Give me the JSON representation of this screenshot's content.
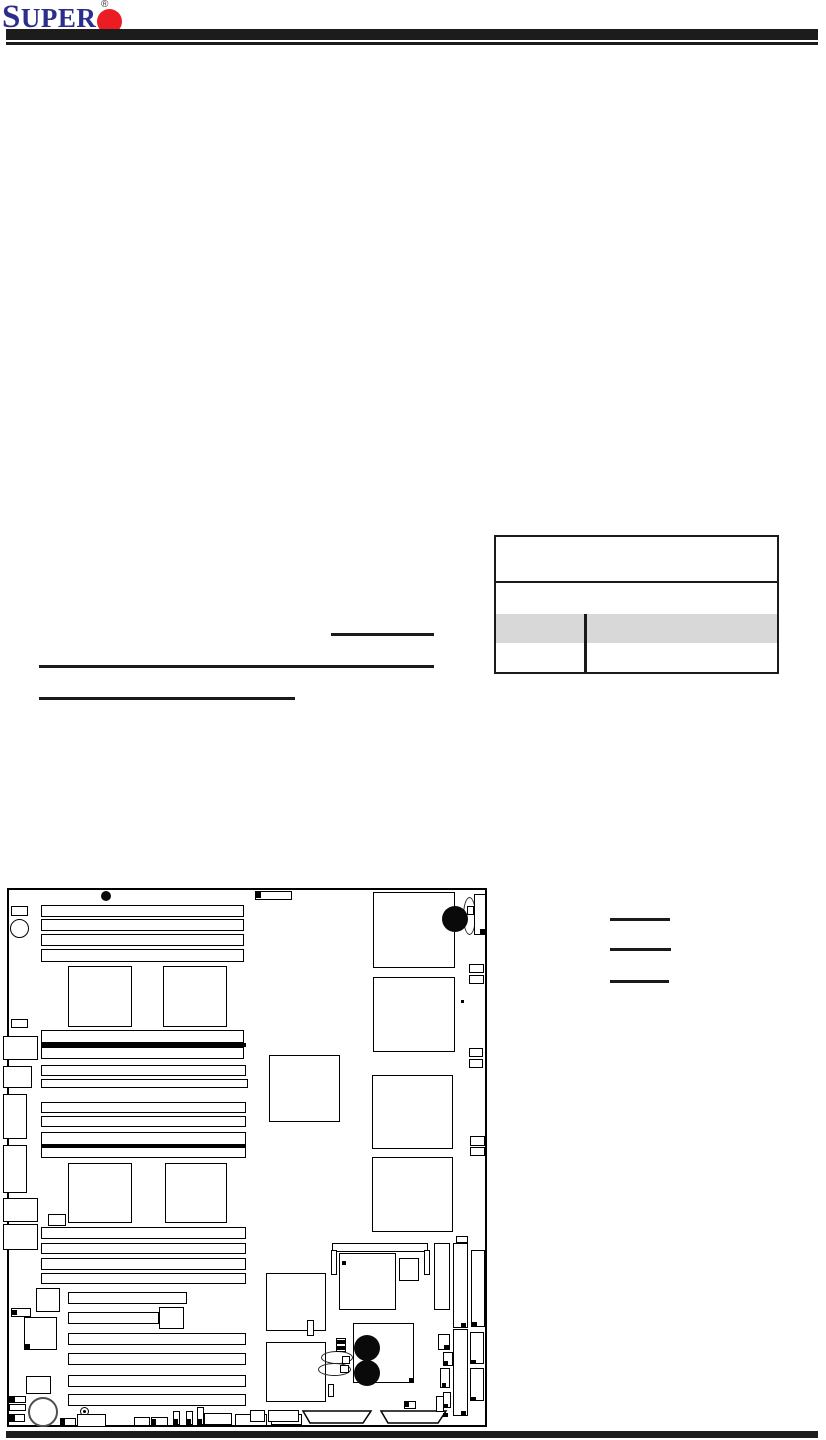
{
  "header": {
    "logo_text": "SUPER",
    "registered_mark": "®"
  },
  "colors": {
    "logo_blue": "#2b2e8c",
    "logo_red": "#ec1c24",
    "rule_black": "#1c1c1c",
    "table_shaded_row": "#d8d8d8"
  },
  "table": {
    "note": "empty specification table with header row, one plain row, one shaded row and one bottom row, split by a vertical divider"
  },
  "annotations": {
    "lines": [
      {
        "n": "text-underline-1",
        "x": 331,
        "y": 633,
        "w": 103,
        "h": 3
      },
      {
        "n": "text-underline-2",
        "x": 39,
        "y": 665,
        "w": 395,
        "h": 3
      },
      {
        "n": "text-underline-3",
        "x": 39,
        "y": 697,
        "w": 256,
        "h": 3
      },
      {
        "n": "legend-line-1",
        "x": 610,
        "y": 918,
        "w": 60,
        "h": 3
      },
      {
        "n": "legend-line-2",
        "x": 610,
        "y": 948,
        "w": 61,
        "h": 3
      },
      {
        "n": "legend-line-3",
        "x": 610,
        "y": 980,
        "w": 59,
        "h": 3
      }
    ]
  },
  "diagram": {
    "description": "motherboard layout drawing",
    "shapes": [
      {
        "t": "box",
        "x": 7,
        "y": 888,
        "w": 480,
        "h": 539,
        "bw": 2,
        "n": "board-outline"
      },
      {
        "t": "fillcircle",
        "x": 101,
        "y": 891,
        "w": 10,
        "h": 10,
        "n": "mounting-hole"
      },
      {
        "t": "box",
        "x": 11,
        "y": 906,
        "w": 17,
        "h": 10,
        "n": "connector"
      },
      {
        "t": "circle",
        "x": 10,
        "y": 919,
        "w": 19,
        "h": 19,
        "n": "mounting-hole"
      },
      {
        "t": "box",
        "x": 255,
        "y": 891,
        "w": 37,
        "h": 9,
        "n": "connector"
      },
      {
        "t": "fill",
        "x": 256,
        "y": 892,
        "w": 5,
        "h": 6,
        "n": "pin1-mark"
      },
      {
        "t": "box",
        "x": 41,
        "y": 905,
        "w": 203,
        "h": 12,
        "n": "dimm-slot"
      },
      {
        "t": "box",
        "x": 41,
        "y": 919,
        "w": 203,
        "h": 12,
        "n": "dimm-slot"
      },
      {
        "t": "box",
        "x": 41,
        "y": 934,
        "w": 203,
        "h": 12,
        "n": "dimm-slot"
      },
      {
        "t": "box",
        "x": 41,
        "y": 949,
        "w": 203,
        "h": 13,
        "n": "dimm-slot"
      },
      {
        "t": "box",
        "x": 68,
        "y": 966,
        "w": 64,
        "h": 61,
        "n": "cpu-socket"
      },
      {
        "t": "box",
        "x": 163,
        "y": 966,
        "w": 64,
        "h": 61,
        "n": "cpu-socket"
      },
      {
        "t": "box",
        "x": 373,
        "y": 892,
        "w": 82,
        "h": 76,
        "n": "chip"
      },
      {
        "t": "ellipse",
        "x": 463,
        "y": 897,
        "w": 13,
        "h": 38,
        "n": "battery"
      },
      {
        "t": "box",
        "x": 474,
        "y": 894,
        "w": 12,
        "h": 41,
        "n": "connector"
      },
      {
        "t": "fillcircle",
        "x": 442,
        "y": 906,
        "w": 26,
        "h": 26,
        "n": "capacitor"
      },
      {
        "t": "box",
        "x": 467,
        "y": 906,
        "w": 7,
        "h": 9,
        "n": "connector"
      },
      {
        "t": "fill",
        "x": 480,
        "y": 929,
        "w": 5,
        "h": 5,
        "n": "pin1-mark"
      },
      {
        "t": "box",
        "x": 469,
        "y": 964,
        "w": 15,
        "h": 9,
        "n": "connector"
      },
      {
        "t": "box",
        "x": 469,
        "y": 975,
        "w": 15,
        "h": 9,
        "n": "connector"
      },
      {
        "t": "box",
        "x": 373,
        "y": 977,
        "w": 82,
        "h": 75,
        "n": "chip"
      },
      {
        "t": "fill",
        "x": 461,
        "y": 1000,
        "w": 3,
        "h": 3,
        "n": "dot"
      },
      {
        "t": "box",
        "x": 11,
        "y": 1019,
        "w": 17,
        "h": 9,
        "n": "connector"
      },
      {
        "t": "box",
        "x": 41,
        "y": 1030,
        "w": 203,
        "h": 13,
        "n": "dimm-slot"
      },
      {
        "t": "fill",
        "x": 41,
        "y": 1043,
        "w": 205,
        "h": 4,
        "n": "slot-divider"
      },
      {
        "t": "box",
        "x": 41,
        "y": 1047,
        "w": 203,
        "h": 12,
        "n": "dimm-slot"
      },
      {
        "t": "box",
        "x": 41,
        "y": 1065,
        "w": 205,
        "h": 11,
        "n": "dimm-slot"
      },
      {
        "t": "box",
        "x": 41,
        "y": 1079,
        "w": 207,
        "h": 9,
        "n": "dimm-slot"
      },
      {
        "t": "box",
        "x": 3,
        "y": 1036,
        "w": 35,
        "h": 24,
        "n": "io-port"
      },
      {
        "t": "box",
        "x": 3,
        "y": 1066,
        "w": 29,
        "h": 22,
        "n": "io-port"
      },
      {
        "t": "box",
        "x": 3,
        "y": 1094,
        "w": 24,
        "h": 45,
        "n": "io-port"
      },
      {
        "t": "box",
        "x": 3,
        "y": 1145,
        "w": 24,
        "h": 48,
        "n": "io-port"
      },
      {
        "t": "box",
        "x": 3,
        "y": 1198,
        "w": 35,
        "h": 24,
        "n": "io-port"
      },
      {
        "t": "box",
        "x": 3,
        "y": 1224,
        "w": 35,
        "h": 26,
        "n": "io-port"
      },
      {
        "t": "box",
        "x": 41,
        "y": 1102,
        "w": 205,
        "h": 11,
        "n": "dimm-slot"
      },
      {
        "t": "box",
        "x": 41,
        "y": 1116,
        "w": 205,
        "h": 11,
        "n": "dimm-slot"
      },
      {
        "t": "box",
        "x": 41,
        "y": 1132,
        "w": 205,
        "h": 26,
        "n": "dimm-slot"
      },
      {
        "t": "fill",
        "x": 41,
        "y": 1144,
        "w": 205,
        "h": 4,
        "n": "slot-divider"
      },
      {
        "t": "box",
        "x": 269,
        "y": 1055,
        "w": 71,
        "h": 67,
        "n": "chipset"
      },
      {
        "t": "box",
        "x": 372,
        "y": 1075,
        "w": 81,
        "h": 74,
        "n": "chip"
      },
      {
        "t": "box",
        "x": 469,
        "y": 1048,
        "w": 14,
        "h": 9,
        "n": "connector"
      },
      {
        "t": "box",
        "x": 469,
        "y": 1059,
        "w": 14,
        "h": 9,
        "n": "connector"
      },
      {
        "t": "box",
        "x": 372,
        "y": 1157,
        "w": 81,
        "h": 75,
        "n": "chip"
      },
      {
        "t": "box",
        "x": 470,
        "y": 1136,
        "w": 15,
        "h": 10,
        "n": "connector"
      },
      {
        "t": "box",
        "x": 470,
        "y": 1147,
        "w": 15,
        "h": 9,
        "n": "connector"
      },
      {
        "t": "box",
        "x": 68,
        "y": 1163,
        "w": 64,
        "h": 60,
        "n": "cpu-socket"
      },
      {
        "t": "box",
        "x": 165,
        "y": 1163,
        "w": 62,
        "h": 60,
        "n": "cpu-socket"
      },
      {
        "t": "box",
        "x": 48,
        "y": 1214,
        "w": 18,
        "h": 12,
        "n": "connector"
      },
      {
        "t": "box",
        "x": 41,
        "y": 1227,
        "w": 205,
        "h": 12,
        "n": "dimm-slot"
      },
      {
        "t": "box",
        "x": 41,
        "y": 1243,
        "w": 205,
        "h": 11,
        "n": "dimm-slot"
      },
      {
        "t": "box",
        "x": 41,
        "y": 1258,
        "w": 205,
        "h": 12,
        "n": "dimm-slot"
      },
      {
        "t": "box",
        "x": 41,
        "y": 1273,
        "w": 205,
        "h": 11,
        "n": "dimm-slot"
      },
      {
        "t": "box",
        "x": 36,
        "y": 1288,
        "w": 24,
        "h": 24,
        "n": "chip"
      },
      {
        "t": "box",
        "x": 68,
        "y": 1292,
        "w": 119,
        "h": 12,
        "n": "pci-slot"
      },
      {
        "t": "box",
        "x": 11,
        "y": 1308,
        "w": 20,
        "h": 9,
        "n": "connector"
      },
      {
        "t": "fill",
        "x": 12,
        "y": 1310,
        "w": 5,
        "h": 5,
        "n": "pin1-mark"
      },
      {
        "t": "box",
        "x": 24,
        "y": 1317,
        "w": 33,
        "h": 33,
        "n": "chip"
      },
      {
        "t": "fill",
        "x": 25,
        "y": 1344,
        "w": 5,
        "h": 5,
        "n": "pin1-mark"
      },
      {
        "t": "box",
        "x": 68,
        "y": 1312,
        "w": 91,
        "h": 12,
        "n": "pci-slot"
      },
      {
        "t": "box",
        "x": 159,
        "y": 1307,
        "w": 25,
        "h": 22,
        "n": "chip"
      },
      {
        "t": "box",
        "x": 68,
        "y": 1333,
        "w": 178,
        "h": 12,
        "n": "pci-slot"
      },
      {
        "t": "box",
        "x": 68,
        "y": 1353,
        "w": 178,
        "h": 12,
        "n": "pci-slot"
      },
      {
        "t": "box",
        "x": 26,
        "y": 1376,
        "w": 25,
        "h": 18,
        "n": "chip"
      },
      {
        "t": "box",
        "x": 68,
        "y": 1375,
        "w": 178,
        "h": 12,
        "n": "pci-slot"
      },
      {
        "t": "box",
        "x": 68,
        "y": 1394,
        "w": 178,
        "h": 12,
        "n": "pci-slot"
      },
      {
        "t": "box",
        "x": 9,
        "y": 1396,
        "w": 17,
        "h": 7,
        "n": "connector"
      },
      {
        "t": "fill",
        "x": 10,
        "y": 1397,
        "w": 5,
        "h": 5,
        "n": "pin1-mark"
      },
      {
        "t": "box",
        "x": 9,
        "y": 1404,
        "w": 17,
        "h": 7,
        "n": "connector"
      },
      {
        "t": "box",
        "x": 9,
        "y": 1414,
        "w": 16,
        "h": 8,
        "n": "connector"
      },
      {
        "t": "fill",
        "x": 10,
        "y": 1415,
        "w": 5,
        "h": 6,
        "n": "pin1-mark"
      },
      {
        "t": "graycircle",
        "x": 28,
        "y": 1397,
        "w": 30,
        "h": 30,
        "n": "buzzer"
      },
      {
        "t": "screw",
        "x": 80,
        "y": 1407,
        "w": 9,
        "h": 9,
        "n": "screw-hole"
      },
      {
        "t": "box",
        "x": 60,
        "y": 1418,
        "w": 16,
        "h": 8,
        "n": "connector"
      },
      {
        "t": "fill",
        "x": 61,
        "y": 1419,
        "w": 4,
        "h": 6,
        "n": "pin1-mark"
      },
      {
        "t": "box",
        "x": 77,
        "y": 1414,
        "w": 29,
        "h": 13,
        "n": "connector"
      },
      {
        "t": "box",
        "x": 134,
        "y": 1417,
        "w": 16,
        "h": 9,
        "n": "connector"
      },
      {
        "t": "box",
        "x": 151,
        "y": 1417,
        "w": 17,
        "h": 9,
        "n": "connector"
      },
      {
        "t": "fill",
        "x": 152,
        "y": 1419,
        "w": 4,
        "h": 6,
        "n": "pin1-mark"
      },
      {
        "t": "box",
        "x": 173,
        "y": 1411,
        "w": 7,
        "h": 14,
        "n": "connector"
      },
      {
        "t": "fill",
        "x": 174,
        "y": 1419,
        "w": 4,
        "h": 5,
        "n": "pin1-mark"
      },
      {
        "t": "box",
        "x": 186,
        "y": 1411,
        "w": 7,
        "h": 14,
        "n": "connector"
      },
      {
        "t": "fill",
        "x": 187,
        "y": 1419,
        "w": 4,
        "h": 5,
        "n": "pin1-mark"
      },
      {
        "t": "box",
        "x": 197,
        "y": 1407,
        "w": 7,
        "h": 18,
        "n": "connector"
      },
      {
        "t": "fill",
        "x": 198,
        "y": 1419,
        "w": 4,
        "h": 5,
        "n": "pin1-mark"
      },
      {
        "t": "box",
        "x": 204,
        "y": 1413,
        "w": 28,
        "h": 12,
        "n": "connector"
      },
      {
        "t": "box",
        "x": 235,
        "y": 1414,
        "w": 32,
        "h": 12,
        "n": "connector"
      },
      {
        "t": "box",
        "x": 271,
        "y": 1414,
        "w": 31,
        "h": 11,
        "n": "connector"
      },
      {
        "t": "trap",
        "x": 302,
        "y": 1411,
        "w": 70,
        "h": 13,
        "n": "edge-connector"
      },
      {
        "t": "trap",
        "x": 380,
        "y": 1411,
        "w": 67,
        "h": 13,
        "n": "edge-connector"
      },
      {
        "t": "box",
        "x": 250,
        "y": 1410,
        "w": 15,
        "h": 12,
        "n": "connector"
      },
      {
        "t": "box",
        "x": 268,
        "y": 1410,
        "w": 31,
        "h": 12,
        "n": "connector"
      },
      {
        "t": "box",
        "x": 266,
        "y": 1273,
        "w": 60,
        "h": 58,
        "n": "chip"
      },
      {
        "t": "box",
        "x": 266,
        "y": 1342,
        "w": 60,
        "h": 60,
        "n": "chip"
      },
      {
        "t": "box",
        "x": 332,
        "y": 1243,
        "w": 96,
        "h": 9,
        "n": "connector"
      },
      {
        "t": "box",
        "x": 331,
        "y": 1250,
        "w": 6,
        "h": 25,
        "n": "connector"
      },
      {
        "t": "box",
        "x": 424,
        "y": 1250,
        "w": 6,
        "h": 25,
        "n": "connector"
      },
      {
        "t": "box",
        "x": 339,
        "y": 1253,
        "w": 57,
        "h": 57,
        "n": "chip"
      },
      {
        "t": "fill",
        "x": 342,
        "y": 1261,
        "w": 4,
        "h": 4,
        "n": "pin1-mark"
      },
      {
        "t": "box",
        "x": 399,
        "y": 1258,
        "w": 20,
        "h": 23,
        "n": "chip"
      },
      {
        "t": "box",
        "x": 434,
        "y": 1243,
        "w": 16,
        "h": 67,
        "n": "connector"
      },
      {
        "t": "box",
        "x": 456,
        "y": 1236,
        "w": 12,
        "h": 7,
        "n": "connector"
      },
      {
        "t": "box",
        "x": 453,
        "y": 1243,
        "w": 15,
        "h": 85,
        "n": "sata-port"
      },
      {
        "t": "fill",
        "x": 461,
        "y": 1323,
        "w": 5,
        "h": 4,
        "n": "pin1-mark"
      },
      {
        "t": "box",
        "x": 471,
        "y": 1250,
        "w": 14,
        "h": 77,
        "n": "sata-port"
      },
      {
        "t": "fill",
        "x": 472,
        "y": 1322,
        "w": 5,
        "h": 4,
        "n": "pin1-mark"
      },
      {
        "t": "box",
        "x": 453,
        "y": 1329,
        "w": 15,
        "h": 87,
        "n": "sata-port"
      },
      {
        "t": "fill",
        "x": 461,
        "y": 1411,
        "w": 5,
        "h": 4,
        "n": "pin1-mark"
      },
      {
        "t": "box",
        "x": 470,
        "y": 1332,
        "w": 14,
        "h": 32,
        "n": "connector"
      },
      {
        "t": "fill",
        "x": 471,
        "y": 1360,
        "w": 5,
        "h": 4,
        "n": "pin1-mark"
      },
      {
        "t": "box",
        "x": 470,
        "y": 1368,
        "w": 14,
        "h": 33,
        "n": "connector"
      },
      {
        "t": "fill",
        "x": 471,
        "y": 1397,
        "w": 5,
        "h": 4,
        "n": "pin1-mark"
      },
      {
        "t": "box",
        "x": 438,
        "y": 1334,
        "w": 12,
        "h": 16,
        "n": "connector"
      },
      {
        "t": "fill",
        "x": 444,
        "y": 1345,
        "w": 5,
        "h": 5,
        "n": "pin1-mark"
      },
      {
        "t": "box",
        "x": 443,
        "y": 1352,
        "w": 10,
        "h": 14,
        "n": "connector"
      },
      {
        "t": "fill",
        "x": 444,
        "y": 1361,
        "w": 4,
        "h": 4,
        "n": "pin1-mark"
      },
      {
        "t": "box",
        "x": 440,
        "y": 1368,
        "w": 10,
        "h": 20,
        "n": "connector"
      },
      {
        "t": "fill",
        "x": 442,
        "y": 1383,
        "w": 4,
        "h": 4,
        "n": "pin1-mark"
      },
      {
        "t": "box",
        "x": 436,
        "y": 1396,
        "w": 8,
        "h": 16,
        "n": "connector"
      },
      {
        "t": "box",
        "x": 443,
        "y": 1392,
        "w": 8,
        "h": 16,
        "n": "connector"
      },
      {
        "t": "fill",
        "x": 444,
        "y": 1404,
        "w": 4,
        "h": 4,
        "n": "pin1-mark"
      },
      {
        "t": "fill",
        "x": 443,
        "y": 1413,
        "w": 5,
        "h": 4,
        "n": "pin1-mark"
      },
      {
        "t": "box",
        "x": 353,
        "y": 1323,
        "w": 61,
        "h": 60,
        "n": "vrm-block"
      },
      {
        "t": "fill",
        "x": 409,
        "y": 1378,
        "w": 4,
        "h": 4,
        "n": "pin1-mark"
      },
      {
        "t": "fillcircle",
        "x": 354,
        "y": 1335,
        "w": 26,
        "h": 26,
        "n": "capacitor"
      },
      {
        "t": "fillcircle",
        "x": 354,
        "y": 1360,
        "w": 26,
        "h": 26,
        "n": "capacitor"
      },
      {
        "t": "ellipse",
        "x": 321,
        "y": 1351,
        "w": 32,
        "h": 13,
        "n": "jumper-cap"
      },
      {
        "t": "ellipse",
        "x": 318,
        "y": 1363,
        "w": 33,
        "h": 13,
        "n": "jumper-cap"
      },
      {
        "t": "box",
        "x": 336,
        "y": 1338,
        "w": 10,
        "h": 14,
        "n": "jumper"
      },
      {
        "t": "fill",
        "x": 337,
        "y": 1340,
        "w": 8,
        "h": 4,
        "n": "jumper-pin"
      },
      {
        "t": "fill",
        "x": 337,
        "y": 1346,
        "w": 8,
        "h": 4,
        "n": "jumper-pin"
      },
      {
        "t": "box",
        "x": 342,
        "y": 1356,
        "w": 8,
        "h": 8,
        "n": "jumper"
      },
      {
        "t": "box",
        "x": 340,
        "y": 1365,
        "w": 9,
        "h": 8,
        "n": "jumper"
      },
      {
        "t": "box",
        "x": 328,
        "y": 1384,
        "w": 6,
        "h": 13,
        "n": "connector"
      },
      {
        "t": "box",
        "x": 307,
        "y": 1320,
        "w": 7,
        "h": 16,
        "n": "connector"
      },
      {
        "t": "box",
        "x": 404,
        "y": 1401,
        "w": 12,
        "h": 8,
        "n": "connector"
      },
      {
        "t": "fill",
        "x": 405,
        "y": 1402,
        "w": 4,
        "h": 5,
        "n": "pin1-mark"
      }
    ]
  }
}
